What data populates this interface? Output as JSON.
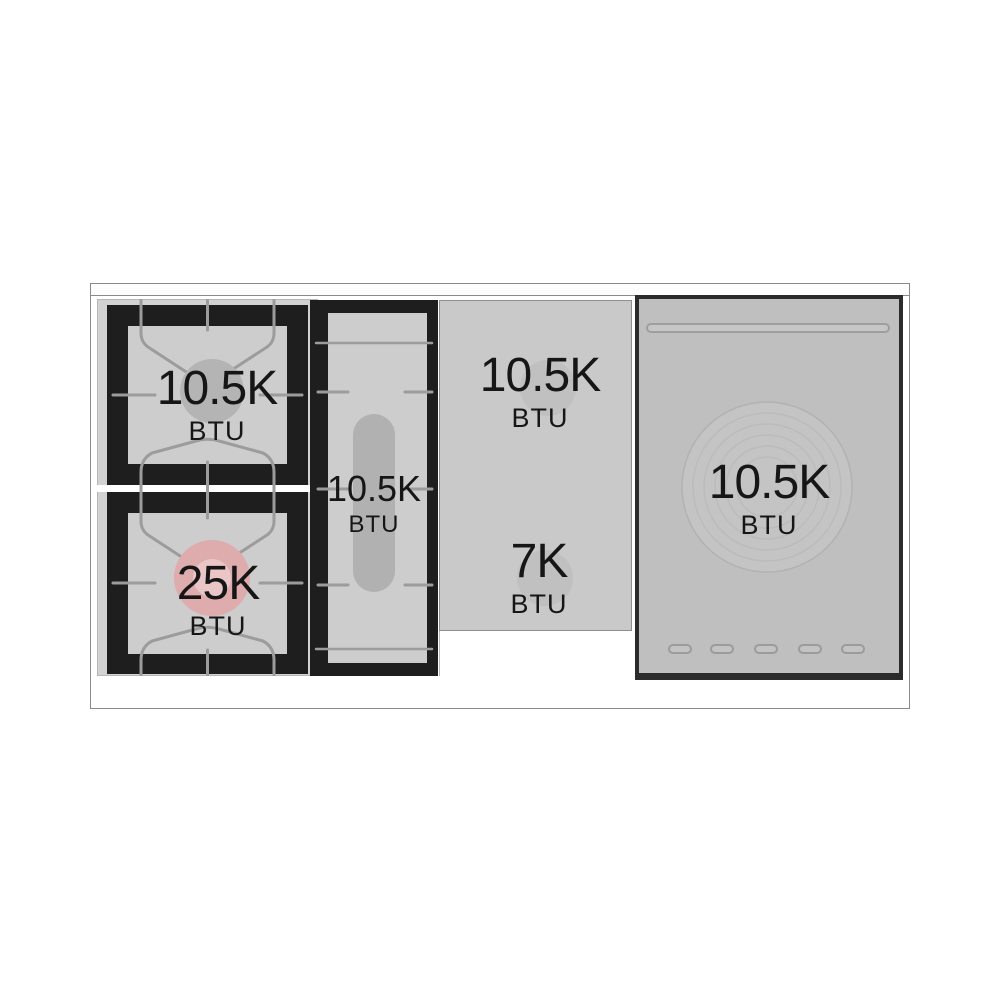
{
  "cooktop": {
    "description": "Range cooktop burner layout diagram with BTU ratings",
    "burners": [
      {
        "id": "left-rear-gas-burner",
        "btu": "10.5K",
        "unit": "BTU"
      },
      {
        "id": "left-front-gas-burner",
        "btu": "25K",
        "unit": "BTU"
      },
      {
        "id": "center-griddle-burner",
        "btu": "10.5K",
        "unit": "BTU"
      },
      {
        "id": "french-top-rear-burner",
        "btu": "10.5K",
        "unit": "BTU"
      },
      {
        "id": "french-top-front-burner",
        "btu": "7K",
        "unit": "BTU"
      },
      {
        "id": "right-zone-burner",
        "btu": "10.5K",
        "unit": "BTU"
      }
    ],
    "colors": {
      "grate_black": "#1e1e1e",
      "surface_gray": "#cdcdcd",
      "panel_gray": "#c9c9c9",
      "right_panel_gray": "#bfbfbf",
      "burner_cap_gray": "#b4b4b4",
      "high_power_pink": "#dfacae",
      "grate_line_gray": "#9c9c9c",
      "frame_border_gray": "#8a8a8a",
      "text_color": "#161616"
    }
  }
}
